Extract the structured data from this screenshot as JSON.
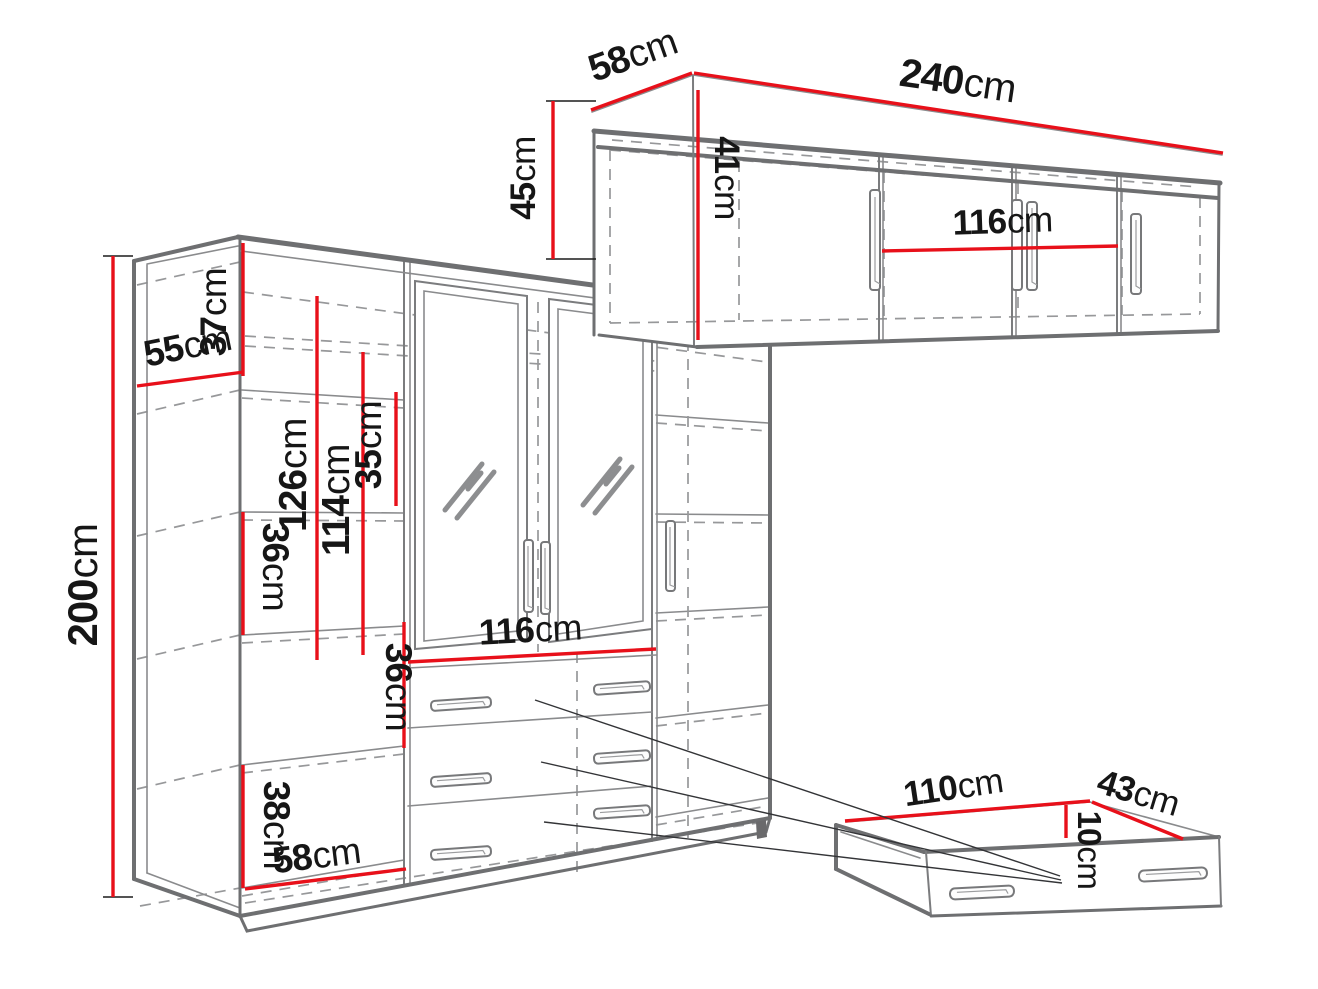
{
  "title": "Furniture dimensions diagram",
  "colors": {
    "dimension_red": "#e8101a",
    "outline_gray": "#6e6f71",
    "dashed_gray": "#97989a",
    "label_black": "#161616",
    "background": "#ffffff"
  },
  "wardrobe": {
    "dims": {
      "height": {
        "value": "200",
        "unit": "cm"
      },
      "side_depth": {
        "value": "55",
        "unit": "cm"
      },
      "top_section_height": {
        "value": "37",
        "unit": "cm"
      },
      "left_hanging_height": {
        "value": "126",
        "unit": "cm"
      },
      "center_hanging_height": {
        "value": "114",
        "unit": "cm"
      },
      "upper_shelf_gap": {
        "value": "35",
        "unit": "cm"
      },
      "left_shelf_gap": {
        "value": "36",
        "unit": "cm"
      },
      "center_shelf_gap": {
        "value": "36",
        "unit": "cm"
      },
      "lower_shelf_gap": {
        "value": "38",
        "unit": "cm"
      },
      "interior_depth": {
        "value": "58",
        "unit": "cm"
      },
      "center_section_width": {
        "value": "116",
        "unit": "cm"
      }
    }
  },
  "top_cabinet": {
    "dims": {
      "depth": {
        "value": "58",
        "unit": "cm"
      },
      "width": {
        "value": "240",
        "unit": "cm"
      },
      "height": {
        "value": "45",
        "unit": "cm"
      },
      "door_height": {
        "value": "41",
        "unit": "cm"
      },
      "center_section_width": {
        "value": "116",
        "unit": "cm"
      }
    }
  },
  "drawer_unit": {
    "dims": {
      "width": {
        "value": "110",
        "unit": "cm"
      },
      "depth": {
        "value": "43",
        "unit": "cm"
      },
      "height": {
        "value": "10",
        "unit": "cm"
      }
    }
  }
}
